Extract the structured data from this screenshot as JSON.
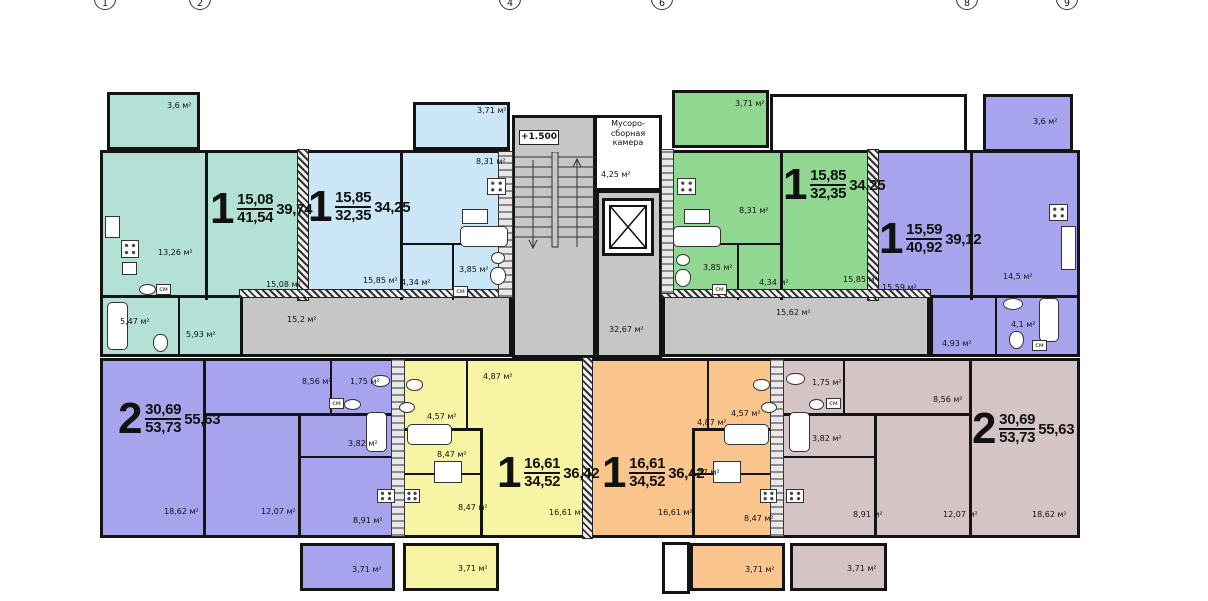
{
  "axes": [
    "1",
    "2",
    "4",
    "6",
    "8",
    "9"
  ],
  "colors": {
    "teal": "#b4e1d6",
    "blue": "#cbe6f7",
    "green": "#90d792",
    "purple": "#a7a3ed",
    "yellow": "#f7f4a4",
    "orange": "#f9c58d",
    "mauve": "#d5c4c6",
    "corridor": "#c6c6c6",
    "wall": "#141414"
  },
  "core": {
    "level_mark": "+1.500",
    "garbage_room_name": "Мусоро-\nсборная\nкамера",
    "garbage_room_area": "4,25 м²"
  },
  "corridors": {
    "left": "15,2 м²",
    "center": "32,67 м²",
    "right": "15,62 м²"
  },
  "apartments": {
    "a1": {
      "type": "1",
      "upper": "15,08",
      "lower": "41,54",
      "total": "39,74",
      "rooms": {
        "balcony": "3,6 м²",
        "kitchen": "13,26 м²",
        "living": "15,08 м²",
        "bath": "5,47 м²",
        "hall": "5,93 м²",
        "washer": "см"
      }
    },
    "a2": {
      "type": "1",
      "upper": "15,85",
      "lower": "32,35",
      "total": "34,25",
      "rooms": {
        "balcony": "3,71 м²",
        "kitchen": "8,31 м²",
        "living": "15,85 м²",
        "hall": "4,34 м²",
        "bath": "3,85 м²",
        "washer": "см"
      }
    },
    "a3": {
      "type": "1",
      "upper": "15,85",
      "lower": "32,35",
      "total": "34,25",
      "rooms": {
        "balcony": "3,71 м²",
        "kitchen": "8,31 м²",
        "living": "15,85 м²",
        "hall": "4,34 м²",
        "bath": "3,85 м²",
        "washer": "см"
      }
    },
    "a4": {
      "type": "1",
      "upper": "15,59",
      "lower": "40,92",
      "total": "39,12",
      "rooms": {
        "balcony": "3,6 м²",
        "living": "15,59 м²",
        "kitchen": "14,5 м²",
        "hall": "4,93 м²",
        "bath": "4,1 м²",
        "washer": "см"
      }
    },
    "b1": {
      "type": "2",
      "upper": "30,69",
      "lower": "53,73",
      "total": "55,63",
      "rooms": {
        "hall": "8,56 м²",
        "wc": "1,75 м²",
        "bath": "3,82 м²",
        "room1": "18,62 м²",
        "room2": "12,07 м²",
        "kitchen": "8,91 м²",
        "washer": "см",
        "balcony": "3,71 м²"
      }
    },
    "b2": {
      "type": "1",
      "upper": "16,61",
      "lower": "34,52",
      "total": "36,42",
      "rooms": {
        "hall": "4,87 м²",
        "bath": "4,57 м²",
        "corridor": "8,47 м²",
        "kitchen": "8,47 м²",
        "living": "16,61 м²",
        "balcony": "3,71 м²"
      }
    },
    "b3": {
      "type": "1",
      "upper": "16,61",
      "lower": "34,52",
      "total": "36,42",
      "rooms": {
        "hall": "4,87 м²",
        "bath": "4,57 м²",
        "corridor": "8,47 м²",
        "kitchen": "8,47 м²",
        "living": "16,61 м²",
        "balcony": "3,71 м²"
      }
    },
    "b4": {
      "type": "2",
      "upper": "30,69",
      "lower": "53,73",
      "total": "55,63",
      "rooms": {
        "hall": "8,56 м²",
        "wc": "1,75 м²",
        "bath": "3,82 м²",
        "room1": "18,62 м²",
        "room2": "12,07 м²",
        "kitchen": "8,91 м²",
        "washer": "см",
        "balcony": "3,71 м²"
      }
    }
  }
}
